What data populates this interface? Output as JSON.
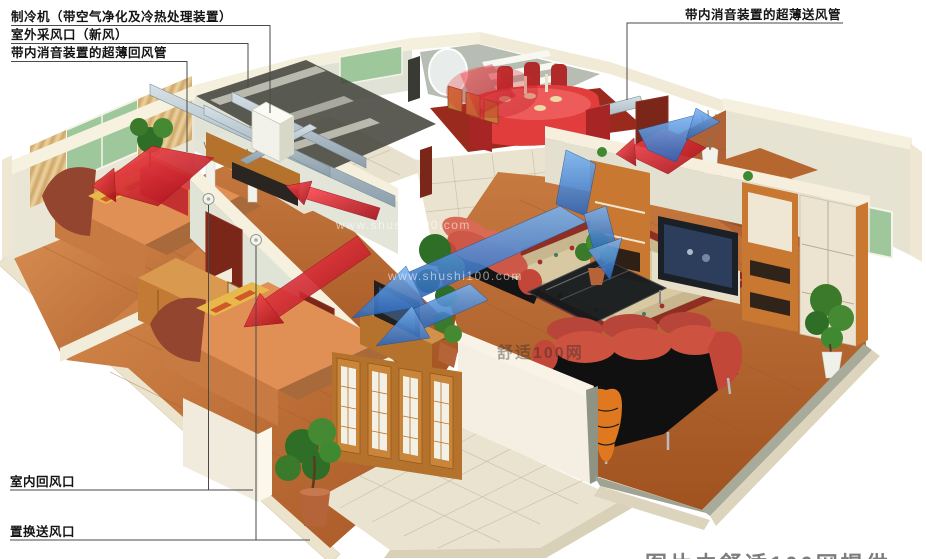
{
  "callouts": {
    "chiller": "制冷机（带空气净化及冷热处理装置）",
    "fresh_air_inlet": "室外采风口（新风）",
    "return_duct": "带内消音装置的超薄回风管",
    "supply_duct": "带内消音装置的超薄送风管",
    "indoor_return_vent": "室内回风口",
    "displacement_supply_vent": "置换送风口"
  },
  "watermarks": {
    "site_url_small": "www.shushi100.com",
    "site_url_large": "www.shushi100.com",
    "brand": "舒适100网"
  },
  "caption_partial": "图片由舒适100网提供",
  "colors": {
    "supply_air_blue": "#3f7fd0",
    "return_air_red": "#dd1722",
    "leader_line": "#4a4a4a",
    "wall_cream": "#f0e9d6",
    "duct_gray": "#b9c6ce",
    "wood_floor": "#c1763c"
  }
}
